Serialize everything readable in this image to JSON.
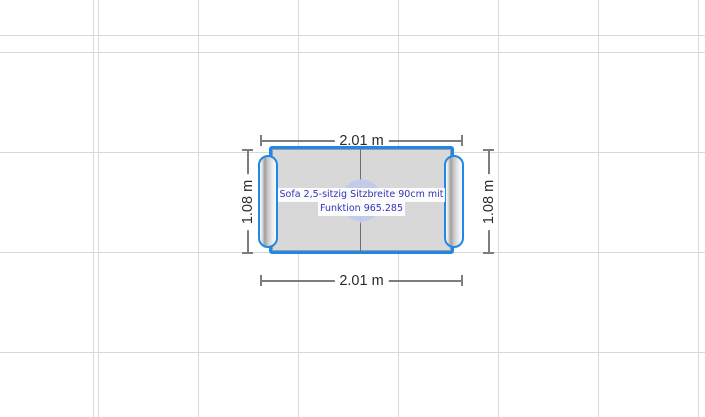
{
  "canvas": {
    "background_color": "#ffffff",
    "grid_color": "#d8d8d8",
    "grid_spacing_px": 100
  },
  "selected_object": {
    "type": "sofa-top-view",
    "label_line1": "Sofa 2,5-sitzig Sitzbreite 90cm mit",
    "label_line2": "Funktion 965.285",
    "label_text_color": "#3434b4",
    "selection_color": "#1f87e8",
    "fill_color": "#d8d8d8",
    "rotate_icon_color": "#c2cbec"
  },
  "dimensions": {
    "top": "2.01 m",
    "bottom": "2.01 m",
    "left": "1.08 m",
    "right": "1.08 m",
    "line_color": "#7d7d7d",
    "text_color": "#2b2b2b"
  }
}
